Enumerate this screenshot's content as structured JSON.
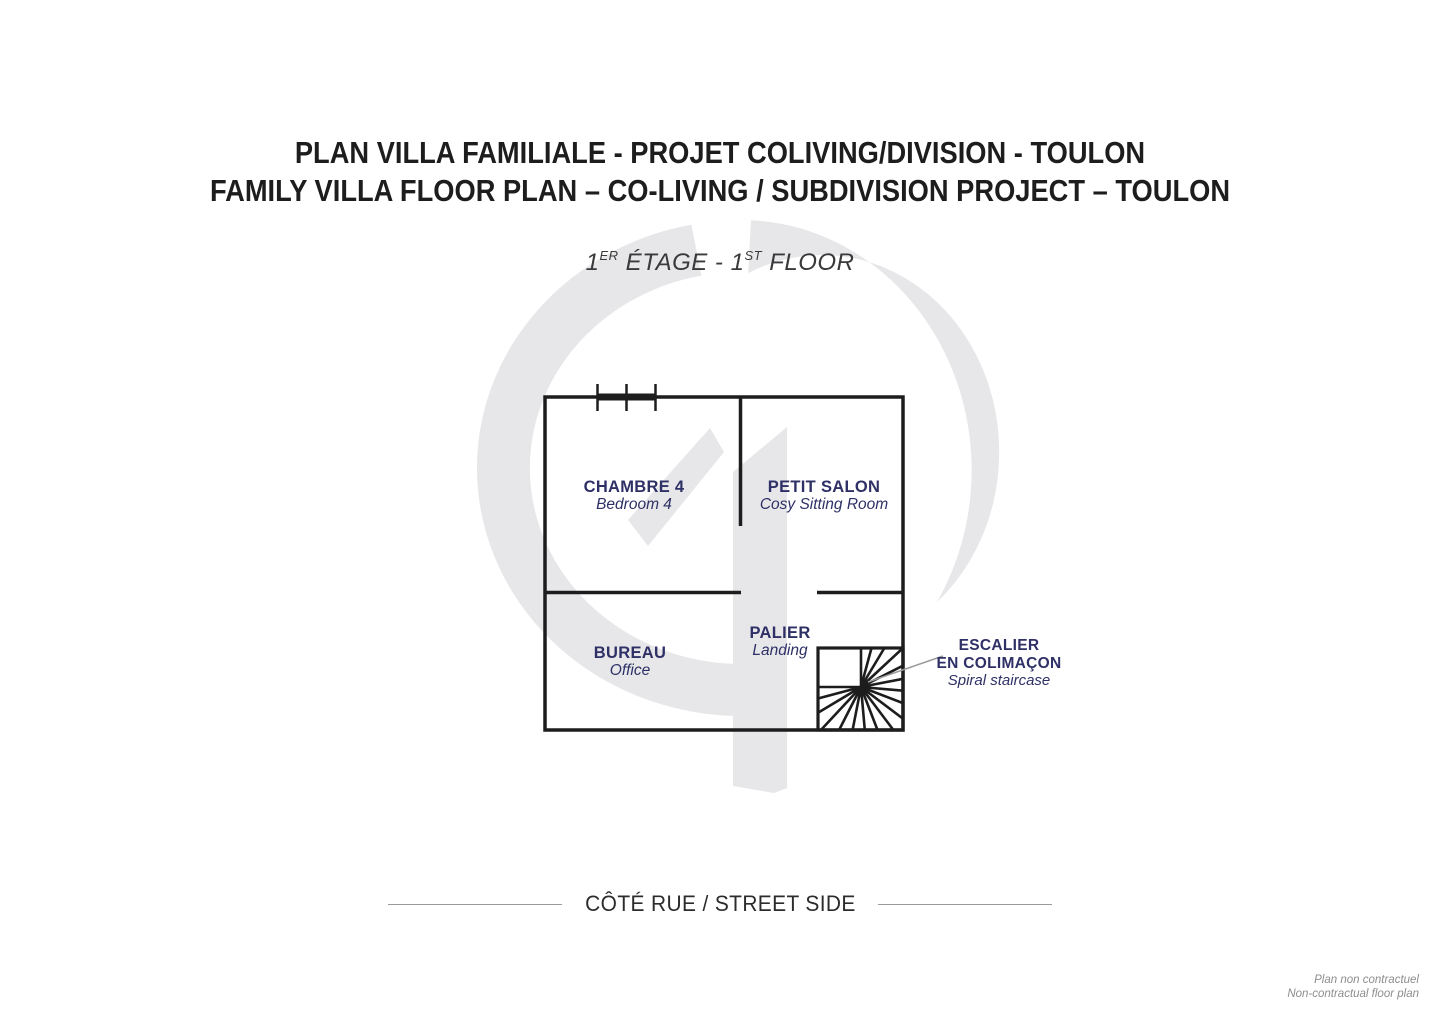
{
  "header": {
    "title_fr": "PLAN VILLA FAMILIALE - PROJET COLIVING/DIVISION - TOULON",
    "title_en": "FAMILY VILLA FLOOR PLAN – CO-LIVING / SUBDIVISION PROJECT – TOULON"
  },
  "floor_label": {
    "num1": "1",
    "sup1": "ER",
    "mid": " ÉTAGE - 1",
    "sup2": "ST",
    "end": " FLOOR"
  },
  "rooms": {
    "chambre4": {
      "fr": "CHAMBRE 4",
      "en": "Bedroom 4"
    },
    "petit_salon": {
      "fr": "PETIT SALON",
      "en": "Cosy Sitting Room"
    },
    "bureau": {
      "fr": "BUREAU",
      "en": "Office"
    },
    "palier": {
      "fr": "PALIER",
      "en": "Landing"
    }
  },
  "staircase_label": {
    "fr_line1": "ESCALIER",
    "fr_line2": "EN COLIMAÇON",
    "en": "Spiral staircase"
  },
  "footer": {
    "street_side": "CÔTÉ RUE / STREET SIDE",
    "disclaimer_fr": "Plan non contractuel",
    "disclaimer_en": "Non-contractual floor plan"
  },
  "colors": {
    "label_navy": "#2e3066",
    "wall_black": "#1d1d1d",
    "watermark_gray": "#e7e7e9",
    "leader_gray": "#9b9b9b"
  }
}
